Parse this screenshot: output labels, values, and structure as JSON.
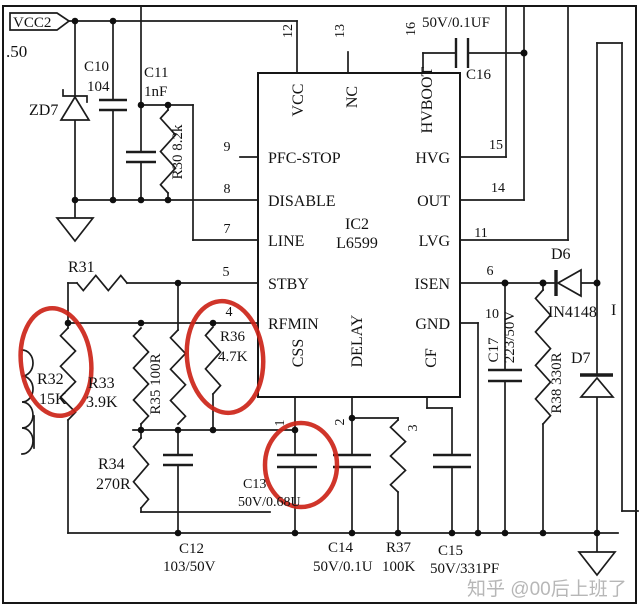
{
  "schematic": {
    "net_flag": "VCC2",
    "edge_text": ".50",
    "stray_text": "I",
    "watermark": "知乎 @00后上班了"
  },
  "ic": {
    "ref": "IC2",
    "part": "L6599",
    "pins_left": [
      {
        "num": "9",
        "name": "PFC-STOP"
      },
      {
        "num": "8",
        "name": "DISABLE"
      },
      {
        "num": "7",
        "name": "LINE"
      },
      {
        "num": "5",
        "name": "STBY"
      },
      {
        "num": "4",
        "name": "RFMIN"
      }
    ],
    "pins_right": [
      {
        "num": "15",
        "name": "HVG"
      },
      {
        "num": "14",
        "name": "OUT"
      },
      {
        "num": "11",
        "name": "LVG"
      },
      {
        "num": "6",
        "name": "ISEN"
      },
      {
        "num": "10",
        "name": "GND"
      }
    ],
    "pins_top": [
      {
        "num": "12",
        "name": "VCC"
      },
      {
        "num": "13",
        "name": "NC"
      },
      {
        "num": "16",
        "name": "HVBOOT"
      }
    ],
    "pins_bottom": [
      {
        "num": "1",
        "name": "CSS"
      },
      {
        "num": "2",
        "name": "DELAY"
      },
      {
        "num": "3",
        "name": "CF"
      }
    ]
  },
  "components": {
    "zd7": {
      "ref": "ZD7"
    },
    "c10": {
      "ref": "C10",
      "value": "104"
    },
    "c11": {
      "ref": "C11",
      "value": "1nF"
    },
    "r30": {
      "label": "R30  8.2k"
    },
    "r31": {
      "ref": "R31"
    },
    "r32": {
      "ref": "R32",
      "value": "15K"
    },
    "r33": {
      "ref": "R33",
      "value": "3.9K"
    },
    "r34": {
      "ref": "R34",
      "value": "270R"
    },
    "r35": {
      "label": "R35  100R"
    },
    "r36": {
      "ref": "R36",
      "value": "4.7K"
    },
    "r37": {
      "ref": "R37",
      "value": "100K"
    },
    "r38": {
      "label": "R38  330R"
    },
    "c12": {
      "ref": "C12",
      "value": "103/50V"
    },
    "c13": {
      "ref": "C13",
      "value": "50V/0.68U"
    },
    "c14": {
      "ref": "C14",
      "value": "50V/0.1U"
    },
    "c15": {
      "ref": "C15",
      "value": "50V/331PF"
    },
    "c16": {
      "ref": "C16",
      "value": "50V/0.1UF"
    },
    "c17": {
      "ref": "C17",
      "value": "223/50V"
    },
    "d6": {
      "ref": "D6",
      "value": "IN4148"
    },
    "d7": {
      "ref": "D7"
    }
  },
  "colors": {
    "highlight": "#cc2418",
    "wire": "#1c1c1c",
    "watermark": "#ababab"
  }
}
